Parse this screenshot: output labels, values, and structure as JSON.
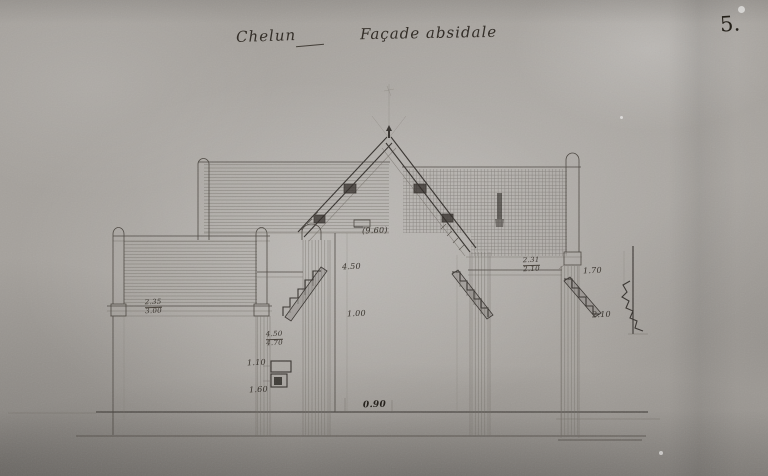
{
  "header": {
    "location": "Chelun",
    "subject": "Façade absidale",
    "plate_number": "5."
  },
  "annotations": {
    "nave_width": "(9.60)",
    "aisle_num": "2.35",
    "aisle_den": "3.00",
    "left_steps_top": "4.50",
    "left_steps_mid": "1.00",
    "left_base_num": "4.50",
    "left_base_den": "4.70",
    "moulding_top": "1.10",
    "moulding_bottom": "1.60",
    "right_ledge_num": "2.31",
    "right_ledge_den": "2.10",
    "outer_steps_top": "1.70",
    "outer_steps_bottom": "2.10",
    "ground_width": "0.90"
  },
  "colors": {
    "paper_gray": "#a5a19c",
    "ink": "#35312d"
  }
}
